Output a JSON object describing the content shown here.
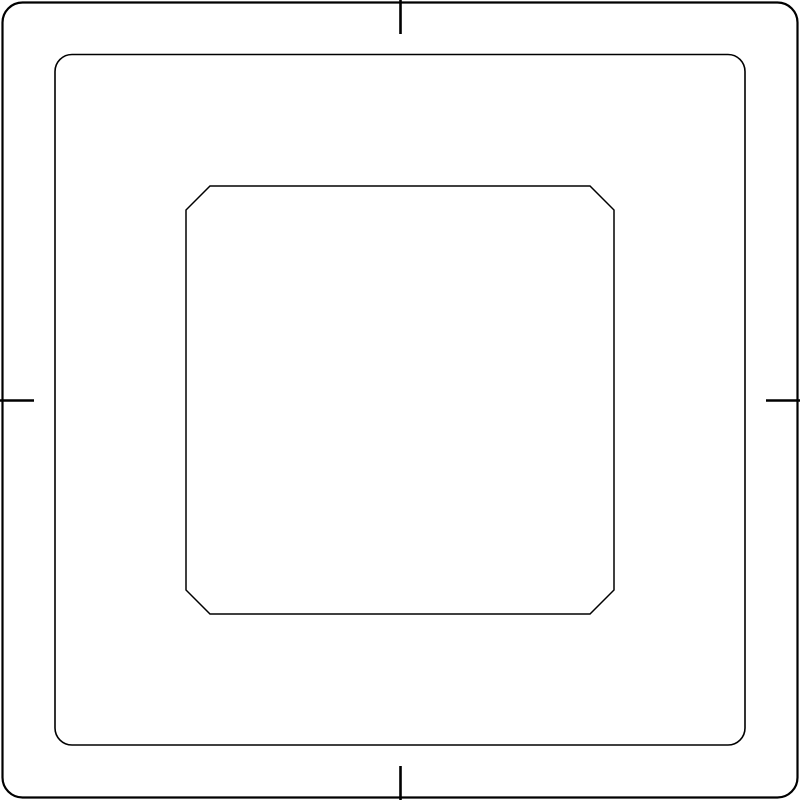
{
  "colors": {
    "background": "#ffffff",
    "line": "#000000"
  },
  "drawing": {
    "canvas": {
      "width": 800,
      "height": 800
    },
    "outer_frame": {
      "x": 2.5,
      "y": 2.5,
      "width": 795,
      "height": 795,
      "corner_radius": 20
    },
    "middle_frame": {
      "x": 55,
      "y": 54.5,
      "width": 690,
      "height": 690.5,
      "corner_radius": 17
    },
    "inner_square": {
      "path": "M 210 186 H 590 L 614 210 V 590 L 590 614 H 210 L 186 590 V 210 Z"
    },
    "ticks": [
      {
        "name": "top",
        "x1": 400.5,
        "y1": 0,
        "x2": 400.5,
        "y2": 34
      },
      {
        "name": "bottom",
        "x1": 400.5,
        "y1": 766,
        "x2": 400.5,
        "y2": 800
      },
      {
        "name": "left",
        "x1": 0,
        "y1": 400.5,
        "x2": 34,
        "y2": 400.5
      },
      {
        "name": "right",
        "x1": 766,
        "y1": 400.5,
        "x2": 800,
        "y2": 400.5
      }
    ]
  }
}
